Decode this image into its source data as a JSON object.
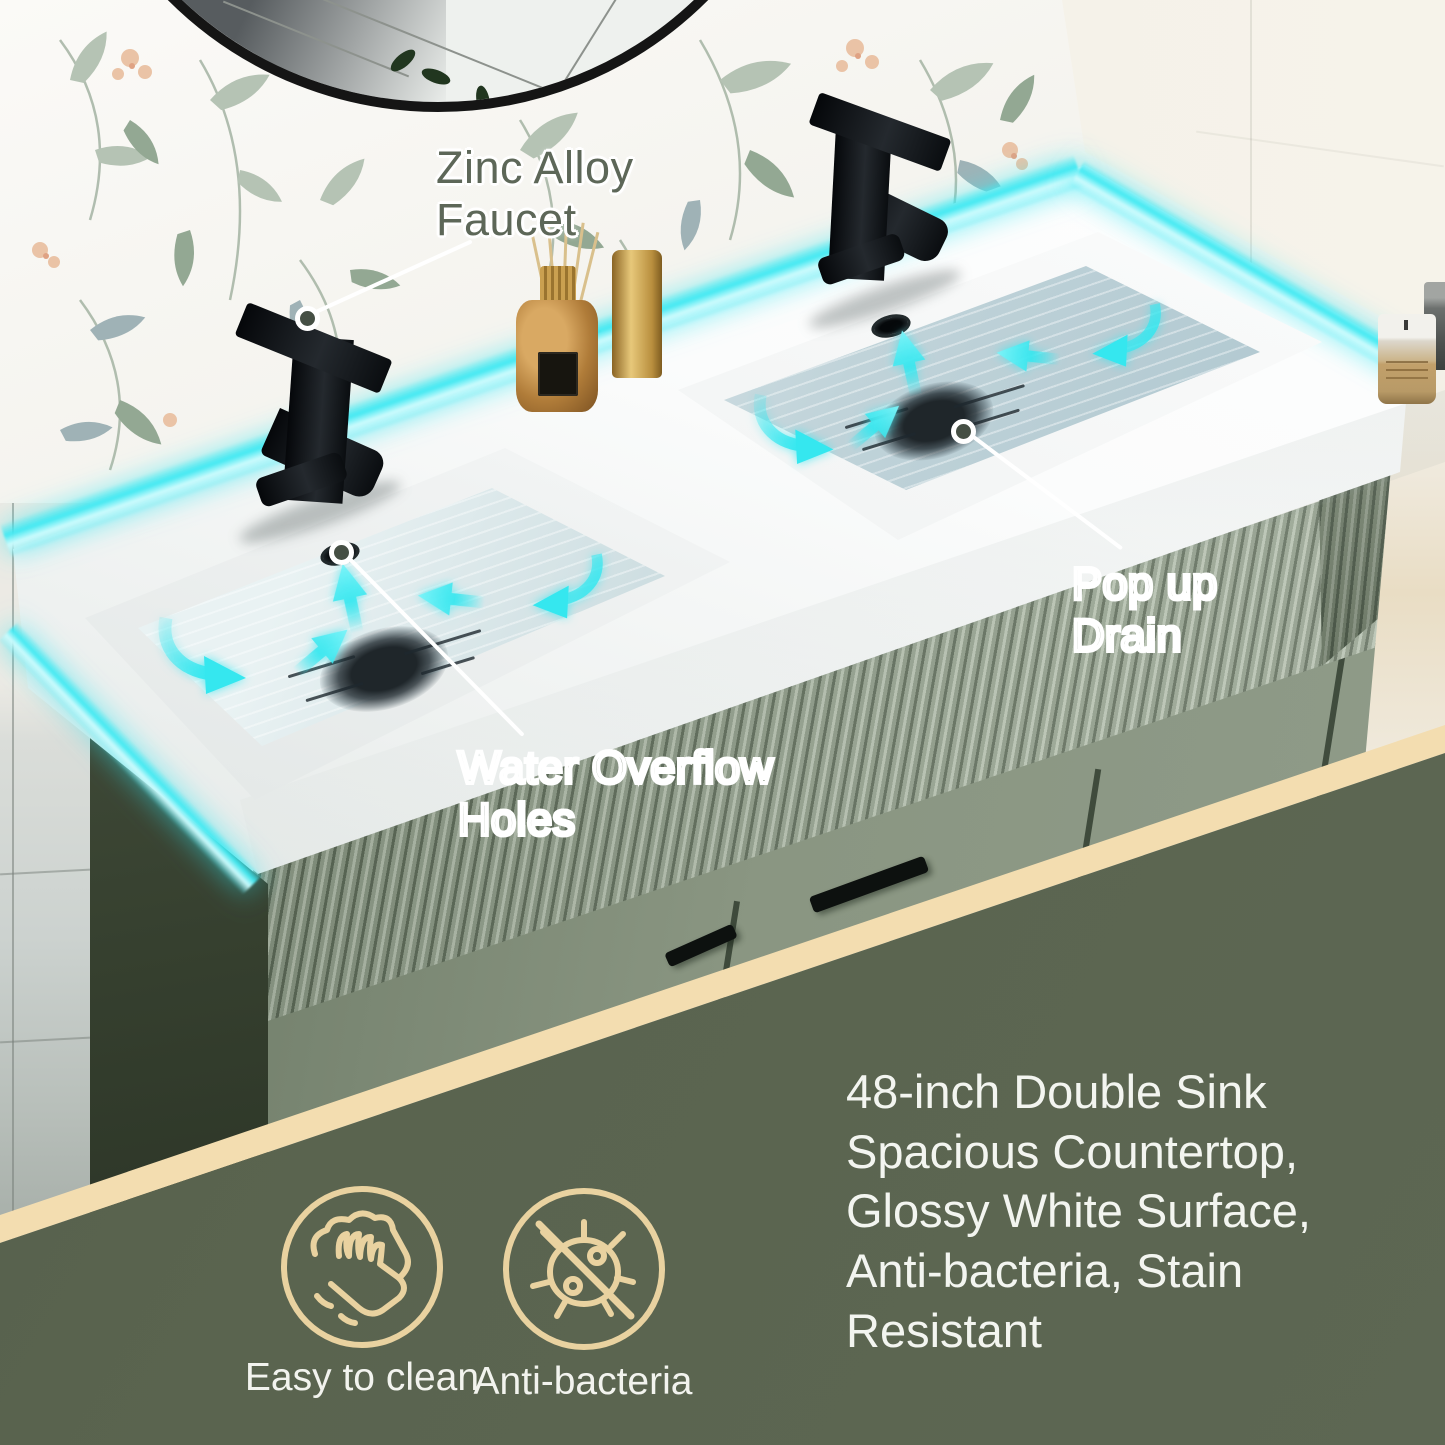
{
  "callouts": {
    "faucet_label": "Zinc Alloy\nFaucet",
    "overflow_label": "Water Overflow\nHoles",
    "drain_label": "Pop up\nDrain"
  },
  "feature_text": "48-inch Double Sink\nSpacious Countertop,\nGlossy White Surface,\nAnti-bacteria, Stain\nResistant",
  "badges": {
    "clean": {
      "icon": "hand-wipe-icon",
      "label": "Easy to clean"
    },
    "bacteria": {
      "icon": "no-bacteria-icon",
      "label": "Anti-bacteria"
    }
  },
  "colors": {
    "glow_accent": "#3fe8f0",
    "panel_green": "#5a644f",
    "band_tan": "#f3ddb0",
    "badge_tan": "#e9d2a0",
    "cabinet_green": "#8a9682",
    "callout_green": "#5d6758",
    "text_white": "#f3f5f0",
    "water_blue": "#b9cfd8"
  }
}
